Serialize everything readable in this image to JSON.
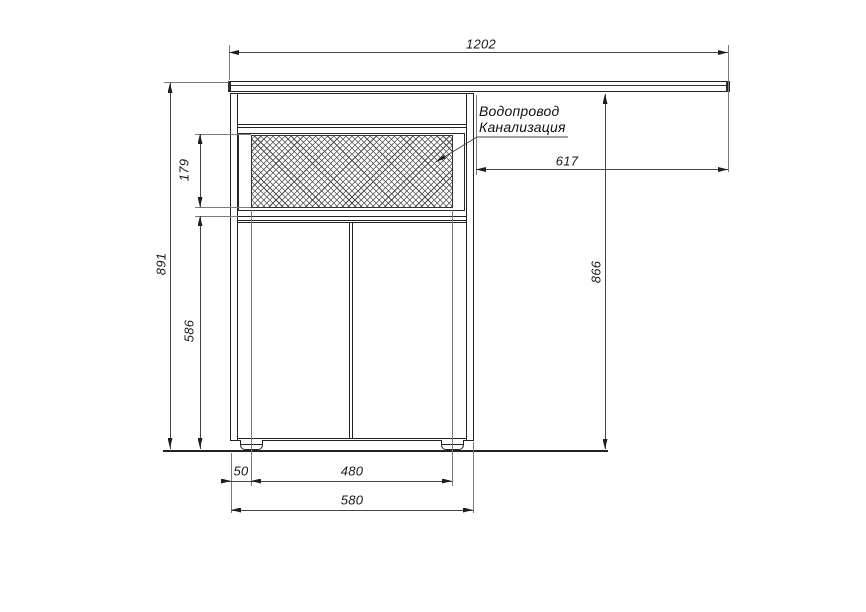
{
  "drawing": {
    "labels": {
      "water_supply": "Водопровод",
      "sewerage": "Канализация"
    },
    "dimensions": {
      "countertop_width": "1202",
      "overhang_width": "617",
      "height_under_top": "866",
      "total_height": "891",
      "service_opening_height": "179",
      "door_height": "586",
      "foot_inset": "50",
      "feet_spacing": "480",
      "cabinet_width": "580"
    },
    "colors": {
      "object_line": "#222222",
      "dimension_line": "#454545",
      "extension_line": "#7a7a7a",
      "text": "#1a1a1a",
      "background": "#ffffff"
    }
  }
}
